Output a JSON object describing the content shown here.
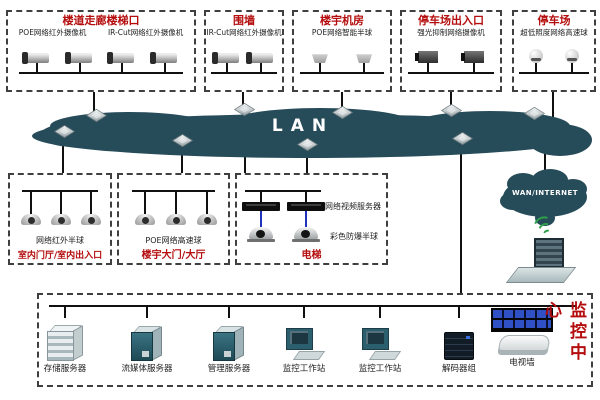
{
  "lan": {
    "label": "LAN"
  },
  "wan": {
    "label": "WAN/INTERNET"
  },
  "top_groups": [
    {
      "title": "楼道走廊楼梯口",
      "label1": "POE网络红外摄像机",
      "label2": "IR-Cut网络红外摄像机",
      "camera_count": 4,
      "camera_type": "bullet-ir-camera"
    },
    {
      "title": "围墙",
      "label1": "IR-Cut网络红外摄像机",
      "camera_count": 2,
      "camera_type": "bullet-ir-camera"
    },
    {
      "title": "楼宇机房",
      "label1": "POE网络智能半球",
      "camera_count": 2,
      "camera_type": "smart-dome-camera"
    },
    {
      "title": "停车场出入口",
      "label1": "强光抑制网络摄像机",
      "camera_count": 2,
      "camera_type": "box-camera"
    },
    {
      "title": "停车场",
      "label1": "超低照度网络高速球",
      "camera_count": 2,
      "camera_type": "speed-dome-camera"
    }
  ],
  "mid_groups": [
    {
      "title": "室内门厅/室内出入口",
      "label": "网络红外半球",
      "camera_count": 3,
      "camera_type": "ir-dome-camera"
    },
    {
      "title": "楼宇大门/大厅",
      "label": "POE网络高速球",
      "camera_count": 3,
      "camera_type": "speed-dome-camera"
    },
    {
      "title": "电梯",
      "label_top": "网络视频服务器",
      "label_bottom": "彩色防爆半球",
      "server_count": 2,
      "camera_count": 2
    }
  ],
  "monitor_center": {
    "title": "监控中心",
    "devices": [
      {
        "label": "存储服务器",
        "icon": "storage-server-icon"
      },
      {
        "label": "流媒体服务器",
        "icon": "tower-server-icon"
      },
      {
        "label": "管理服务器",
        "icon": "tower-server-icon"
      },
      {
        "label": "监控工作站",
        "icon": "workstation-icon"
      },
      {
        "label": "监控工作站",
        "icon": "workstation-icon"
      },
      {
        "label": "解码器组",
        "icon": "decoder-icon"
      },
      {
        "label": "电视墙",
        "icon": "tv-wall-icon"
      }
    ]
  },
  "icons": {
    "switch": "3d-diamond-switch",
    "lan_cloud": "dark-teal-cloud",
    "wan_cloud": "dark-teal-cloud",
    "laptop": "wireless-laptop",
    "wifi": "green-signal-arcs"
  },
  "colors": {
    "cloud": "#264b59",
    "title_red": "#b50d0d",
    "line_black": "#101010",
    "link_blue": "#2233bb",
    "wifi_green": "#2f9e4a",
    "background": "#ffffff"
  }
}
